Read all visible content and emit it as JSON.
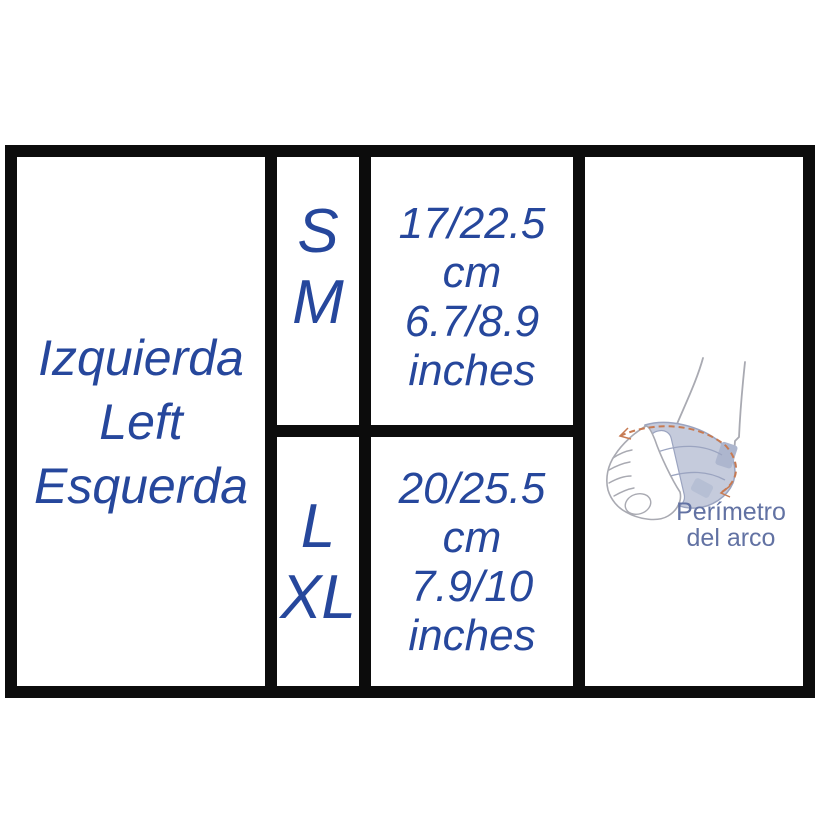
{
  "sizing_table": {
    "side_labels": [
      "Izquierda",
      "Left",
      "Esquerda"
    ],
    "rows": [
      {
        "size_line1": "S",
        "size_line2": "M",
        "range_lines": [
          "17/22.5",
          "cm",
          "6.7/8.9",
          "inches"
        ]
      },
      {
        "size_line1": "L",
        "size_line2": "XL",
        "range_lines": [
          "20/25.5",
          "cm",
          "7.9/10",
          "inches"
        ]
      }
    ],
    "illustration_caption": {
      "line1": "Perímetro",
      "line2": "del arco"
    }
  },
  "chart_data": {
    "type": "table",
    "rows": [
      [
        "Izquierda Left Esquerda",
        "S M",
        "17/22.5 cm 6.7/8.9 inches"
      ],
      [
        "Izquierda Left Esquerda",
        "L XL",
        "20/25.5 cm 7.9/10 inches"
      ]
    ],
    "annotation": "Perímetro del arco"
  },
  "colors": {
    "text_blue": "#26479c",
    "caption_blue_gray": "#6272a3",
    "border_black": "#0c0c0c",
    "wrap_fill": "#c5cbdc",
    "wrap_stroke": "#9ba4c0",
    "foot_outline": "#a9aab2",
    "measure_orange": "#c77a52"
  }
}
